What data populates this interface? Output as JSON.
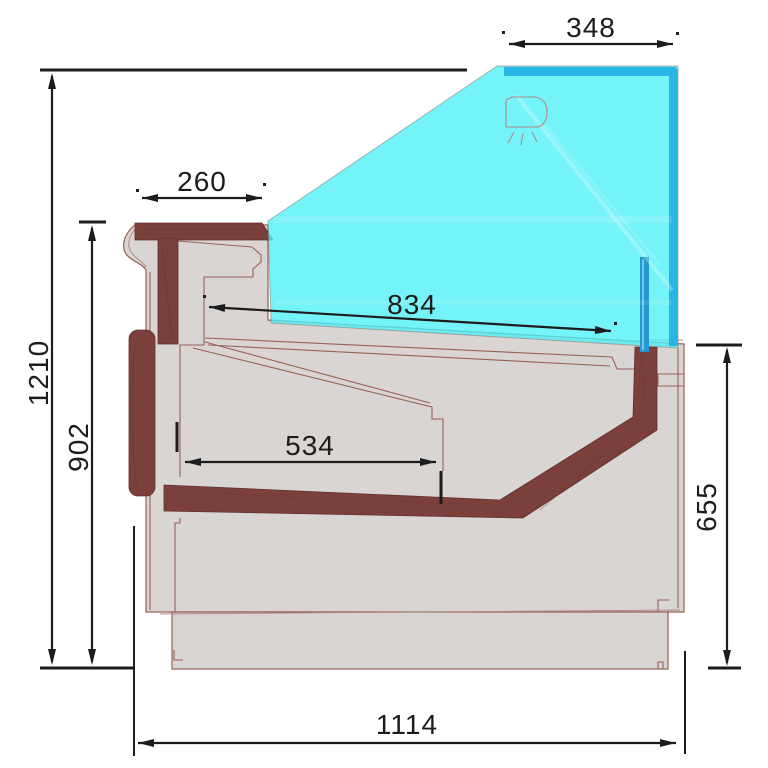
{
  "drawing": {
    "title": "Refrigerated display counter — side cross-section",
    "dimensions": {
      "glass_top": "348",
      "counter_front": "260",
      "glass_slope": "834",
      "deck": "534",
      "overall_height": "1210",
      "front_height": "902",
      "rear_height": "655",
      "overall_depth": "1114"
    },
    "colors": {
      "glass": "#4df0f6",
      "glass_edge": "#29b4e6",
      "divider": "#2398d2",
      "panel": "#7c403c",
      "body": "#d8d5d3",
      "outline": "#9a6058",
      "dimension_lines": "#1c1c1c"
    },
    "icons": [
      "ceiling-lamp-icon"
    ]
  }
}
